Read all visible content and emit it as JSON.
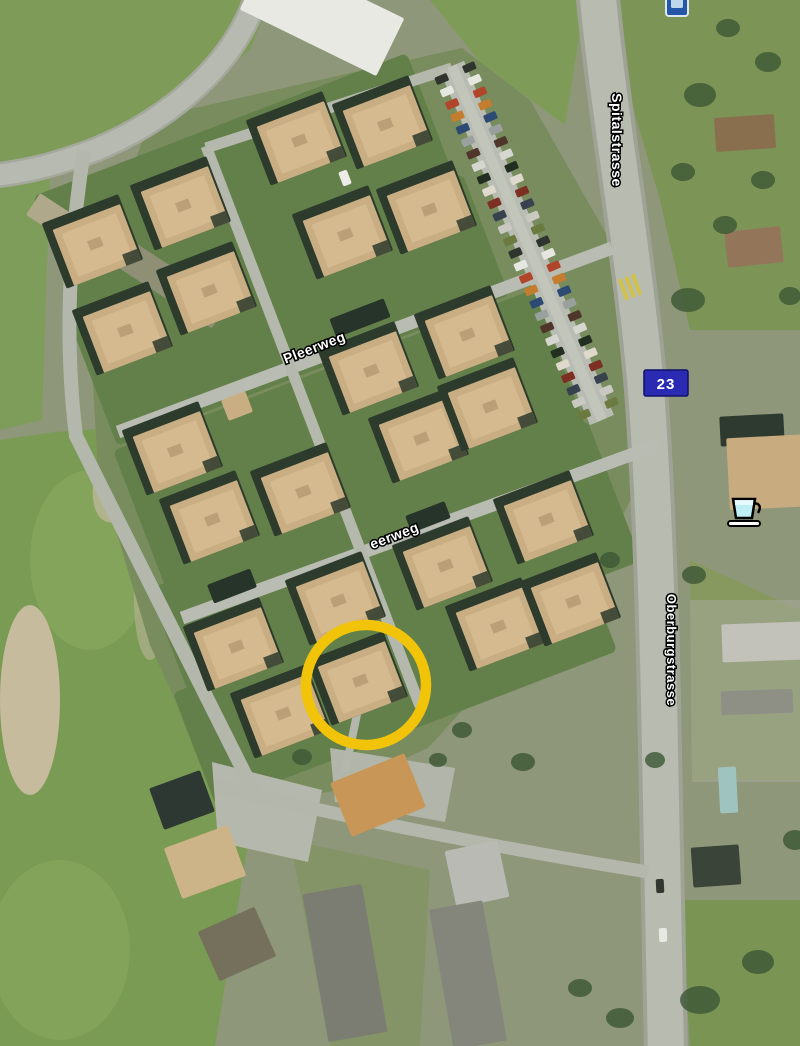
{
  "map": {
    "type": "aerial-satellite-view",
    "labels": {
      "street_top_right": "Spitalstrasse",
      "street_right": "Oberburgstrasse",
      "street_upper": "Pleerweg",
      "street_lower": "eerweg",
      "route_badge": "23"
    },
    "colors": {
      "highlight_ring": "#f2c409",
      "route_badge_bg": "#2a2ab2",
      "route_badge_border": "#10106a",
      "roof_tan": "#c9ae83",
      "roof_shadow": "#2d3b2d",
      "field_green": "#7a9b53",
      "road_gray": "#b8bcb0"
    },
    "icons": [
      {
        "name": "cafe-icon",
        "glyph": "coffee-cup",
        "color": "#bfeff5"
      },
      {
        "name": "roadsign-icon",
        "glyph": "blue-sign",
        "color": "#2457a8"
      }
    ],
    "highlight": {
      "shape": "circle",
      "cx": 366,
      "cy": 685,
      "r": 60
    },
    "buildings": [
      [
        301,
        142
      ],
      [
        387,
        126
      ],
      [
        185,
        207
      ],
      [
        97,
        245
      ],
      [
        347,
        236
      ],
      [
        431,
        211
      ],
      [
        211,
        292
      ],
      [
        127,
        332
      ],
      [
        373,
        372
      ],
      [
        469,
        336
      ],
      [
        423,
        440
      ],
      [
        492,
        408
      ],
      [
        177,
        452
      ],
      [
        305,
        493
      ],
      [
        214,
        521
      ],
      [
        548,
        521
      ],
      [
        447,
        567
      ],
      [
        340,
        602
      ],
      [
        238,
        648
      ],
      [
        362,
        682
      ],
      [
        285,
        715
      ],
      [
        500,
        628
      ],
      [
        575,
        603
      ]
    ],
    "parking": {
      "x1": 452,
      "y1": 66,
      "x2": 602,
      "y2": 420,
      "offset": 15,
      "spacing": 13.5,
      "angle": 67,
      "colors": [
        "#2f352e",
        "#e7e7e1",
        "#b1452b",
        "#c47c2e",
        "#2c4a74",
        "#9aa09e",
        "#50352a",
        "#d6d6d0",
        "#222e20",
        "#ded9cc",
        "#7d2f23",
        "#38424f",
        "#c9c9c1",
        "#6b7a3e"
      ]
    },
    "houses": [
      {
        "name": "white-hall-roof",
        "x": 322,
        "y": 14,
        "w": 152,
        "h": 64,
        "r": 26,
        "fill": "#e9e9e4"
      },
      {
        "name": "farm-building-roof",
        "x": 70,
        "y": 228,
        "w": 88,
        "h": 26,
        "r": 33,
        "fill": "#b0a88a"
      },
      {
        "name": "farm-building-roof",
        "x": 168,
        "y": 282,
        "w": 124,
        "h": 30,
        "r": 33,
        "fill": "#8f8f76"
      },
      {
        "name": "house-roof",
        "x": 745,
        "y": 133,
        "w": 60,
        "h": 34,
        "r": -4,
        "fill": "#8a6f4e"
      },
      {
        "name": "house-roof",
        "x": 754,
        "y": 247,
        "w": 56,
        "h": 36,
        "r": -6,
        "fill": "#93765a"
      },
      {
        "name": "house-roof",
        "x": 752,
        "y": 430,
        "w": 64,
        "h": 30,
        "r": -3,
        "fill": "#2e3a30"
      },
      {
        "name": "house-roof",
        "x": 772,
        "y": 472,
        "w": 88,
        "h": 72,
        "r": -3,
        "fill": "#c8ac80"
      },
      {
        "name": "commercial-roof",
        "x": 762,
        "y": 642,
        "w": 80,
        "h": 38,
        "r": -2,
        "fill": "#c2c2ba"
      },
      {
        "name": "commercial-roof",
        "x": 757,
        "y": 702,
        "w": 72,
        "h": 24,
        "r": -2,
        "fill": "#8e9086"
      },
      {
        "name": "trailer",
        "x": 728,
        "y": 790,
        "w": 18,
        "h": 46,
        "r": -3,
        "fill": "#9fc4bf"
      },
      {
        "name": "house-roof",
        "x": 716,
        "y": 866,
        "w": 48,
        "h": 40,
        "r": -4,
        "fill": "#3a4438"
      },
      {
        "name": "house-roof",
        "x": 378,
        "y": 795,
        "w": 80,
        "h": 58,
        "r": -22,
        "fill": "#c89656"
      },
      {
        "name": "house-roof",
        "x": 205,
        "y": 862,
        "w": 68,
        "h": 54,
        "r": -20,
        "fill": "#cdb488"
      },
      {
        "name": "house-roof",
        "x": 182,
        "y": 800,
        "w": 54,
        "h": 44,
        "r": -20,
        "fill": "#2d3833"
      },
      {
        "name": "house-roof",
        "x": 237,
        "y": 944,
        "w": 62,
        "h": 54,
        "r": -24,
        "fill": "#75705c"
      },
      {
        "name": "house-roof",
        "x": 477,
        "y": 874,
        "w": 54,
        "h": 58,
        "r": -12,
        "fill": "#b9bab4"
      },
      {
        "name": "apartment-roof",
        "x": 345,
        "y": 963,
        "w": 60,
        "h": 150,
        "r": -10,
        "fill": "#7b7c72"
      },
      {
        "name": "apartment-roof",
        "x": 468,
        "y": 975,
        "w": 54,
        "h": 142,
        "r": -10,
        "fill": "#84857b"
      },
      {
        "name": "small-house-roof",
        "x": 237,
        "y": 406,
        "w": 26,
        "h": 22,
        "r": -21,
        "fill": "#c9ae83"
      },
      {
        "name": "garage-roof",
        "x": 360,
        "y": 318,
        "w": 58,
        "h": 20,
        "r": -21,
        "fill": "#26342a"
      },
      {
        "name": "garage-roof",
        "x": 428,
        "y": 517,
        "w": 42,
        "h": 18,
        "r": -21,
        "fill": "#26342a"
      },
      {
        "name": "garage-roof",
        "x": 232,
        "y": 586,
        "w": 46,
        "h": 20,
        "r": -21,
        "fill": "#26342a"
      },
      {
        "name": "car",
        "x": 345,
        "y": 178,
        "w": 9,
        "h": 15,
        "r": -21,
        "fill": "#ecece8"
      },
      {
        "name": "car",
        "x": 660,
        "y": 886,
        "w": 8,
        "h": 14,
        "r": -3,
        "fill": "#32382f"
      },
      {
        "name": "car",
        "x": 663,
        "y": 935,
        "w": 8,
        "h": 14,
        "r": -2,
        "fill": "#e8e8e2"
      }
    ],
    "trees": [
      [
        700,
        95,
        16,
        12
      ],
      [
        768,
        62,
        13,
        10
      ],
      [
        728,
        28,
        12,
        9
      ],
      [
        688,
        300,
        17,
        12
      ],
      [
        790,
        296,
        11,
        9
      ],
      [
        694,
        575,
        12,
        9
      ],
      [
        700,
        1000,
        20,
        14
      ],
      [
        758,
        962,
        16,
        12
      ],
      [
        620,
        1018,
        14,
        10
      ],
      [
        580,
        988,
        12,
        9
      ],
      [
        302,
        757,
        10,
        8
      ],
      [
        523,
        762,
        12,
        9
      ],
      [
        462,
        730,
        10,
        8
      ],
      [
        683,
        172,
        12,
        9
      ],
      [
        725,
        225,
        12,
        9
      ],
      [
        610,
        560,
        10,
        8
      ],
      [
        655,
        760,
        10,
        8
      ],
      [
        795,
        840,
        12,
        10
      ],
      [
        438,
        760,
        9,
        7
      ],
      [
        763,
        180,
        12,
        9
      ]
    ]
  }
}
